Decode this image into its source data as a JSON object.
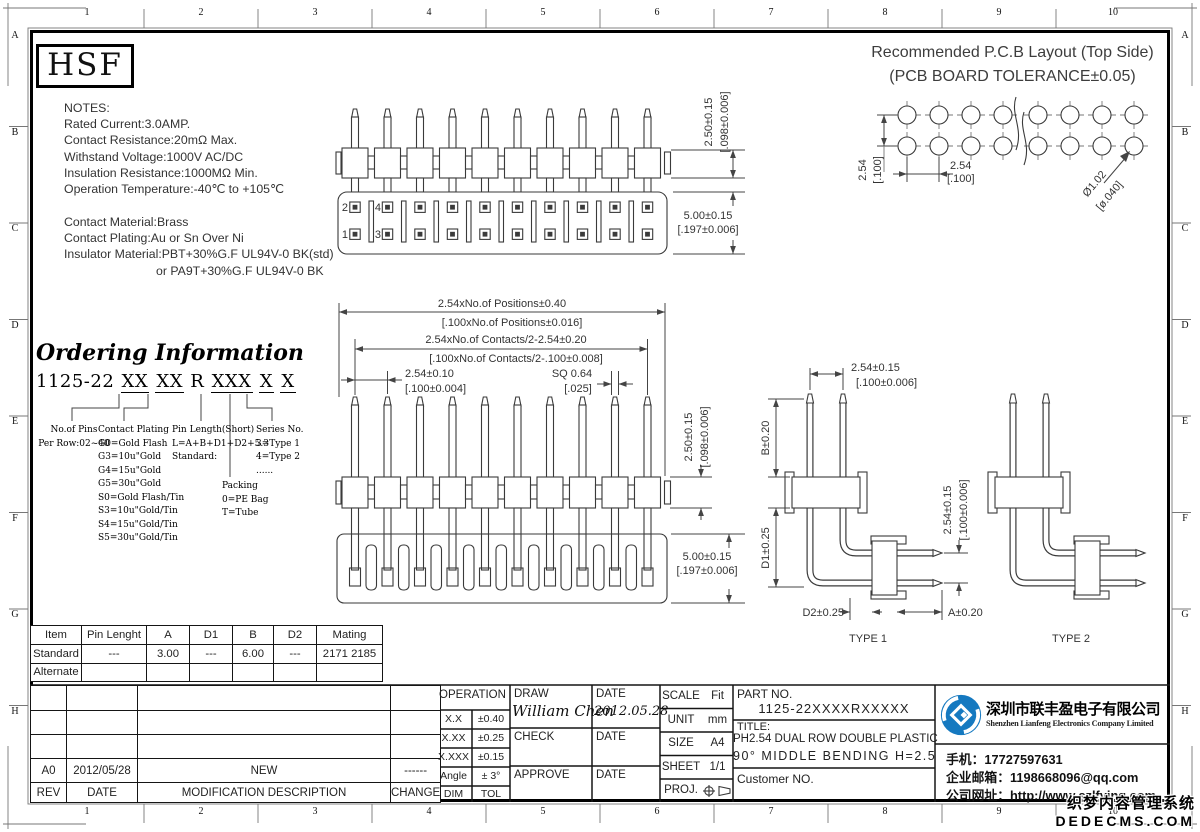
{
  "frame": {
    "columns": [
      "1",
      "2",
      "3",
      "4",
      "5",
      "6",
      "7",
      "8",
      "9",
      "10"
    ],
    "rows": [
      "A",
      "B",
      "C",
      "D",
      "E",
      "F",
      "G",
      "H"
    ]
  },
  "logo": {
    "text": "HSF"
  },
  "notes": {
    "title": "NOTES:",
    "lines": [
      "Rated Current:3.0AMP.",
      "Contact Resistance:20mΩ Max.",
      "Withstand Voltage:1000V AC/DC",
      "Insulation Resistance:1000MΩ Min.",
      "Operation Temperature:-40℃ to +105℃"
    ],
    "material": [
      "Contact Material:Brass",
      "Contact Plating:Au or Sn Over Ni",
      "Insulator Material:PBT+30%G.F UL94V-0 BK(std)",
      "or PA9T+30%G.F UL94V-0 BK"
    ]
  },
  "ordering": {
    "title": "Ordering Information",
    "code_parts": [
      "1125-22",
      "XX",
      "XX",
      "R",
      "XXX",
      "X",
      "X"
    ],
    "pins": [
      "No.of Pins",
      "Per Row:02~40"
    ],
    "plating": [
      "Contact Plating",
      "G0=Gold Flash",
      "G3=10u\"Gold",
      "G4=15u\"Gold",
      "G5=30u\"Gold",
      "S0=Gold Flash/Tin",
      "S3=10u\"Gold/Tin",
      "S4=15u\"Gold/Tin",
      "S5=30u\"Gold/Tin"
    ],
    "pin_length": [
      "Pin Length(Short)",
      "L=A+B+D1+D2+5.3",
      "Standard:"
    ],
    "packing": [
      "Packing",
      "0=PE Bag",
      "T=Tube"
    ],
    "series": [
      "Series No.",
      "3=Type 1",
      "4=Type 2",
      "......"
    ]
  },
  "pcb": {
    "title": "Recommended P.C.B Layout (Top Side)",
    "subtitle": "(PCB BOARD TOLERANCE±0.05)",
    "dim_row": "2.54",
    "dim_row_in": "[.100]",
    "dim_col": "2.54",
    "dim_col_in": "[.100]",
    "dim_hole": "Ø1.02",
    "dim_hole_in": "[ø.040]"
  },
  "view1": {
    "pin_labels": [
      "2",
      "4",
      "1",
      "3"
    ],
    "dim_tail": "2.50±0.15",
    "dim_tail_in": "[.098±0.006]",
    "dim_body": "5.00±0.15",
    "dim_body_in": "[.197±0.006]"
  },
  "view2": {
    "dim_positions": "2.54xNo.of Positions±0.40",
    "dim_positions_in": "[.100xNo.of Positions±0.016]",
    "dim_contacts": "2.54xNo.of Contacts/2-2.54±0.20",
    "dim_contacts_in": "[.100xNo.of Contacts/2-.100±0.008]",
    "dim_pitch": "2.54±0.10",
    "dim_pitch_in": "[.100±0.004]",
    "dim_sq": "SQ 0.64",
    "dim_sq_in": "[.025]",
    "dim_tail": "2.50±0.15",
    "dim_tail_in": "[.098±0.006]",
    "dim_body": "5.00±0.15",
    "dim_body_in": "[.197±0.006]"
  },
  "type1": {
    "caption": "TYPE 1",
    "dim_top": "2.54±0.15",
    "dim_top_in": "[.100±0.006]",
    "dim_b": "B±0.20",
    "dim_d1": "D1±0.25",
    "dim_right": "2.54±0.15",
    "dim_right_in": "[.100±0.006]",
    "dim_d2": "D2±0.25",
    "dim_a": "A±0.20"
  },
  "type2": {
    "caption": "TYPE 2"
  },
  "spec_table": {
    "headers": [
      "Item",
      "Pin Lenght",
      "A",
      "D1",
      "B",
      "D2",
      "Mating"
    ],
    "rows": [
      [
        "Standard",
        "---",
        "3.00",
        "---",
        "6.00",
        "---",
        "2171 2185"
      ],
      [
        "Alternate",
        "",
        "",
        "",
        "",
        "",
        ""
      ]
    ]
  },
  "revision": {
    "row": [
      "A0",
      "2012/05/28",
      "NEW",
      "------"
    ],
    "headers": [
      "REV",
      "DATE",
      "MODIFICATION DESCRIPTION",
      "CHANGE"
    ]
  },
  "title_block": {
    "operation": "OPERATION",
    "tolerances": [
      [
        "X.X",
        "±0.40"
      ],
      [
        "X.XX",
        "±0.25"
      ],
      [
        "X.XXX",
        "±0.15"
      ],
      [
        "Angle",
        "± 3°"
      ],
      [
        "DIM",
        "TOL"
      ]
    ],
    "draw_label": "DRAW",
    "check_label": "CHECK",
    "approve_label": "APPROVE",
    "date_label": "DATE",
    "drawn_by": "William Chen",
    "draw_date": "2012.05.28",
    "scale_label": "SCALE",
    "scale": "Fit",
    "unit_label": "UNIT",
    "unit": "mm",
    "size_label": "SIZE",
    "size": "A4",
    "sheet_label": "SHEET",
    "sheet": "1/1",
    "proj_label": "PROJ.",
    "part_label": "PART NO.",
    "part_no": "1125-22XXXXRXXXXX",
    "title_label": "TITLE:",
    "title_line1": "PH2.54 DUAL ROW DOUBLE PLASTIC",
    "title_line2": "90° MIDDLE BENDING H=2.5",
    "customer_label": "Customer NO."
  },
  "company": {
    "name_cn": "深圳市联丰盈电子有限公司",
    "name_en": "Shenzhen Lianfeng Electronics Company Limited",
    "phone": "手机：17727597631",
    "email": "企业邮箱：1198668096@qq.com",
    "website": "公司网址：http://www.szlfying.com",
    "logo_color": "#1579c0"
  },
  "watermark": {
    "line1": "织梦内容管理系统",
    "line2": "DEDECMS.COM"
  }
}
